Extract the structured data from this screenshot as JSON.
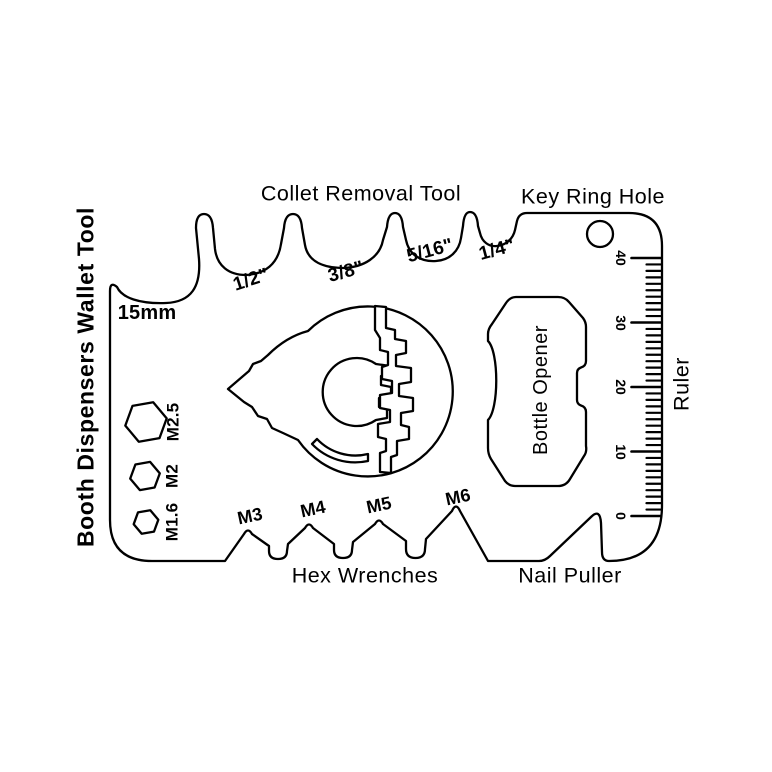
{
  "page": {
    "background": "#ffffff",
    "line_color": "#000000"
  },
  "side_title": "Booth Dispensers Wallet Tool",
  "top": {
    "collet_title": "Collet Removal Tool",
    "key_ring_title": "Key Ring Hole",
    "collet_sizes": [
      "15mm",
      "1/2\"",
      "3/8\"",
      "5/16\"",
      "1/4\""
    ]
  },
  "left_hex_holes": [
    "M2.5",
    "M2",
    "M1.6"
  ],
  "bottom": {
    "hex_title": "Hex Wrenches",
    "nail_title": "Nail Puller",
    "hex_sizes": [
      "M3",
      "M4",
      "M5",
      "M6"
    ]
  },
  "bottle_opener_label": "Bottle Opener",
  "ruler": {
    "label": "Ruler",
    "unit_min": 0,
    "unit_max": 40,
    "major_every": 10,
    "major_labels": [
      "0",
      "10",
      "20",
      "30",
      "40"
    ]
  }
}
